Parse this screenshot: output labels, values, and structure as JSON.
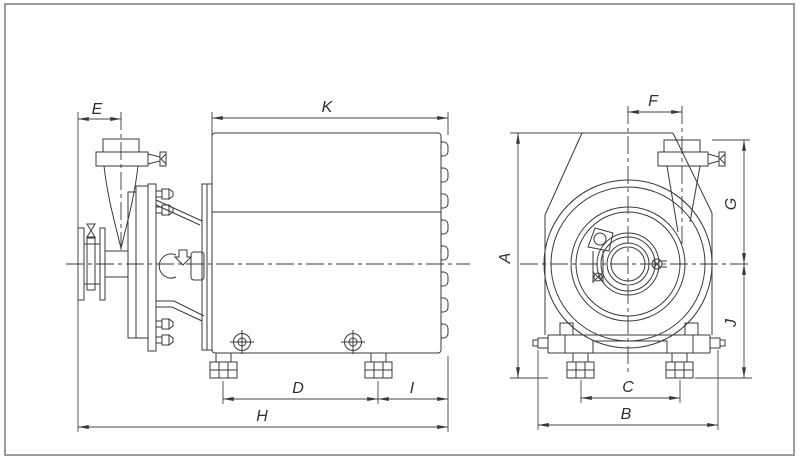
{
  "drawing": {
    "background": "#ffffff",
    "frame_color": "#9b9b9b",
    "line_color": "#3a3a3a",
    "dim_line_color": "#454545",
    "dim_labels": {
      "E": "E",
      "K": "K",
      "D": "D",
      "I": "I",
      "H": "H",
      "F": "F",
      "A": "A",
      "G": "G",
      "J": "J",
      "C": "C",
      "B": "B"
    }
  }
}
